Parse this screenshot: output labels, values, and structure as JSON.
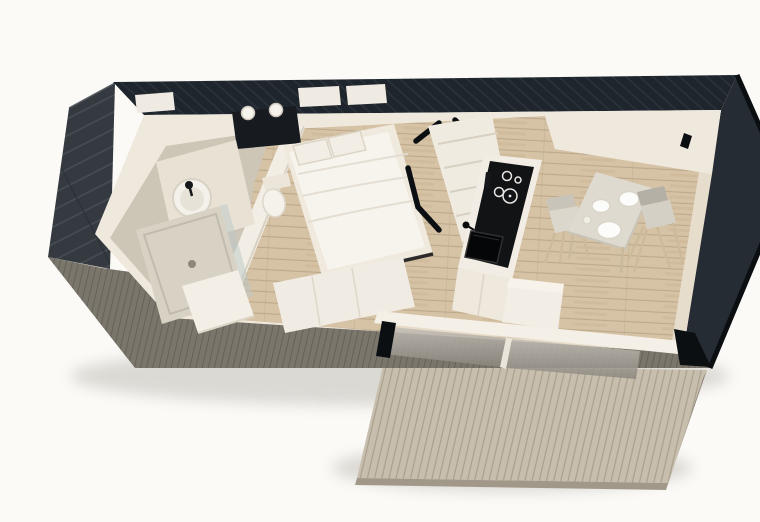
{
  "meta": {
    "title": "3D axonometric cutaway floor plan of a tiny house studio with front wood deck",
    "render_type": "architectural 3D floor plan render",
    "visible_text": "none"
  },
  "colors": {
    "background": "#fbfaf7",
    "top_band_dark": "#1f252c",
    "left_wall_dark": "#343a3f",
    "right_wall_dark": "#262c33",
    "trim_black": "#0c0f12",
    "front_base_dark": "#4a463f",
    "gray_band": "#7b766c",
    "interior_cream": "#efe9dd",
    "wall_white": "#f3eee5",
    "bath_floor": "#cdc6b7",
    "wood_floor": "#d6c3a6",
    "wood_plank_line": "#bda88a",
    "deck_wood": "#c7beae",
    "deck_line": "#a99f8c",
    "deck_edge": "#a2988a",
    "counter_black": "#121315",
    "mirror_black": "#171b20",
    "bedding_white": "#f7f4ed",
    "glass_gray": "#8b867e",
    "shadow": "#8b857a"
  },
  "rooms": [
    {
      "id": "bathroom",
      "label": "Bathroom",
      "features": [
        "walk-in shower with glass panel",
        "round basin vanity with black faucet",
        "dark mirror with two round sconces",
        "toilet",
        "storage bench"
      ]
    },
    {
      "id": "bedroom",
      "label": "Bedroom",
      "features": [
        "double bed with white bedding",
        "two pillows",
        "low wardrobe at foot of bed",
        "black metal frame partition"
      ]
    },
    {
      "id": "kitchen",
      "label": "Kitchen",
      "features": [
        "black countertop strip",
        "induction cooktop",
        "black sink with black faucet",
        "white cabinet fronts",
        "stepped shelf unit"
      ]
    },
    {
      "id": "dining",
      "label": "Dining area",
      "features": [
        "small table",
        "two chairs with wooden legs",
        "white plates on table",
        "entrance door with black handle"
      ]
    },
    {
      "id": "terrace",
      "label": "Front wood deck",
      "features": [
        "narrow plank decking",
        "two sliding glass door panels",
        "black corner posts"
      ]
    }
  ],
  "counts": {
    "cooktop_burners": 4,
    "mirror_sconces": 2,
    "dining_chairs": 2,
    "plates_on_table": 3,
    "glass_door_panels": 2,
    "roof_window_caps": 3
  },
  "materials": {
    "shell": "charcoal stained wood planks",
    "interior_floor": "light oak planks",
    "bathroom_floor": "gray micro-cement",
    "deck": "weathered gray timber boards"
  }
}
